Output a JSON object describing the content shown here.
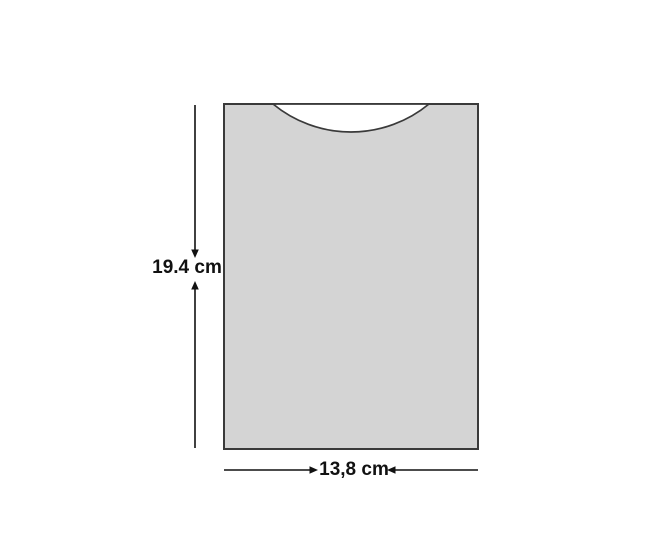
{
  "diagram": {
    "labels": {
      "height": "19.4 cm",
      "width": "13,8 cm"
    },
    "values": {
      "height_cm": 19.4,
      "width_cm": 13.8
    },
    "colors": {
      "background": "#ffffff",
      "shape_fill": "#d4d4d4",
      "shape_stroke": "#3a3a3a",
      "dimension_color": "#111111",
      "label_color": "#111111"
    }
  }
}
